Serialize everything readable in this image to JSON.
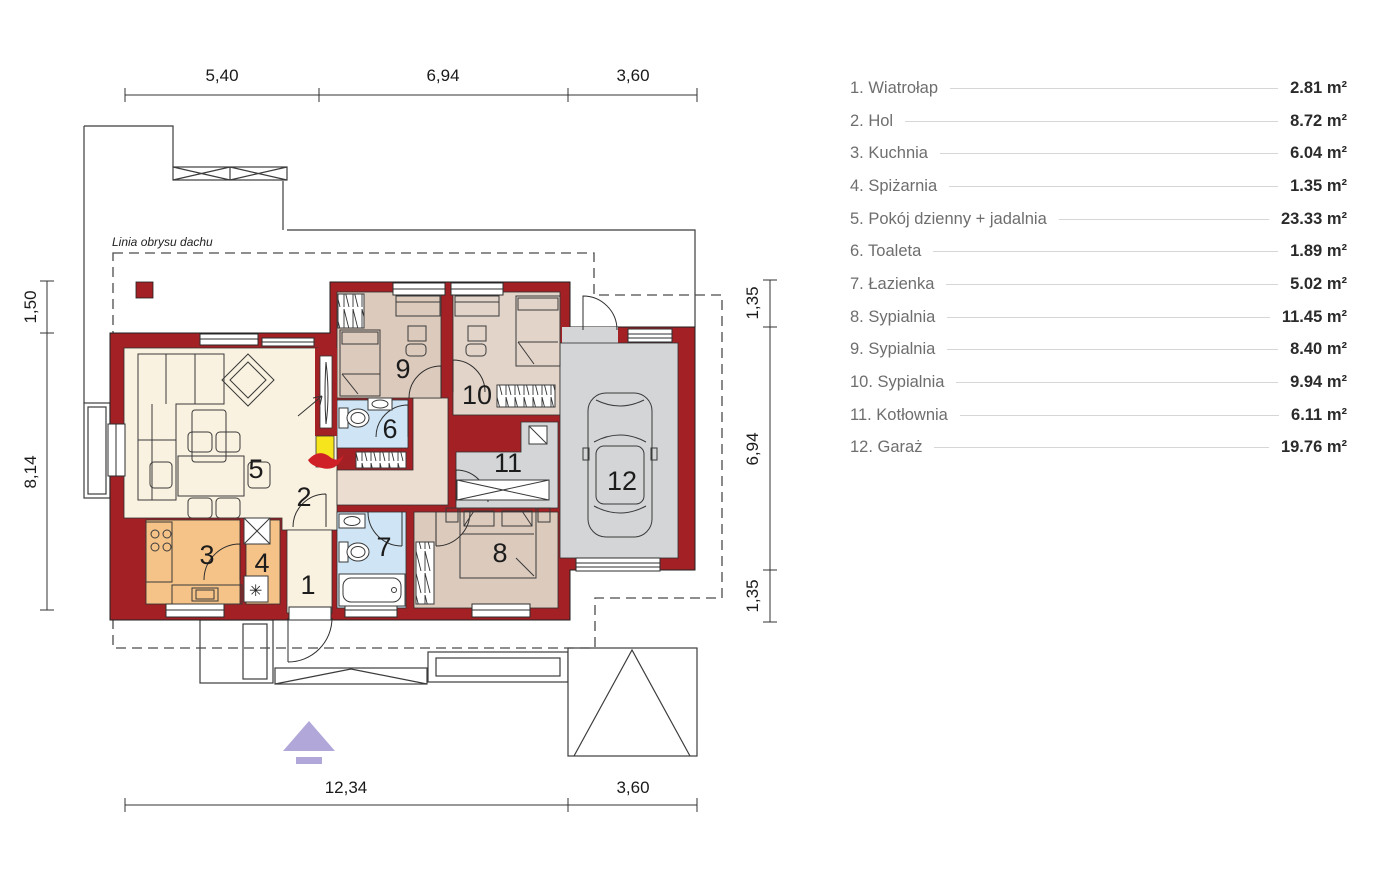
{
  "plan": {
    "roof_outline_label": "Linia obrysu dachu",
    "dimensions": {
      "top": [
        "5,40",
        "6,94",
        "3,60"
      ],
      "bottom": [
        "12,34",
        "3,60"
      ],
      "left": [
        "1,50",
        "8,14"
      ],
      "right": [
        "1,35",
        "6,94",
        "1,35"
      ]
    },
    "room_numbers": [
      "1",
      "2",
      "3",
      "4",
      "5",
      "6",
      "7",
      "8",
      "9",
      "10",
      "11",
      "12"
    ],
    "icons": {
      "freezer_glyph": "✳"
    }
  },
  "legend": {
    "items": [
      {
        "label": "1. Wiatrołap",
        "area": "2.81 m²"
      },
      {
        "label": "2. Hol",
        "area": "8.72 m²"
      },
      {
        "label": "3. Kuchnia",
        "area": "6.04 m²"
      },
      {
        "label": "4. Spiżarnia",
        "area": "1.35 m²"
      },
      {
        "label": "5. Pokój dzienny + jadalnia",
        "area": "23.33 m²"
      },
      {
        "label": "6. Toaleta",
        "area": "1.89 m²"
      },
      {
        "label": "7. Łazienka",
        "area": "5.02 m²"
      },
      {
        "label": "8. Sypialnia",
        "area": "11.45 m²"
      },
      {
        "label": "9. Sypialnia",
        "area": "8.40 m²"
      },
      {
        "label": "10. Sypialnia",
        "area": "9.94 m²"
      },
      {
        "label": "11. Kotłownia",
        "area": "6.11 m²"
      },
      {
        "label": "12. Garaż",
        "area": "19.76 m²"
      }
    ]
  },
  "colors": {
    "wall": "#a32125",
    "floor_cream": "#faf2e1",
    "floor_beige": "#ecddd1",
    "floor_tan": "#dccabd",
    "floor_tan_light": "#e3d4c9",
    "floor_orange": "#f5c388",
    "floor_blue": "#cfe5f5",
    "floor_gray": "#d3d5d7",
    "fireplace_yellow": "#f6e41c",
    "flame_red": "#cf2027",
    "arrow_lavender": "#b2a7d9"
  }
}
